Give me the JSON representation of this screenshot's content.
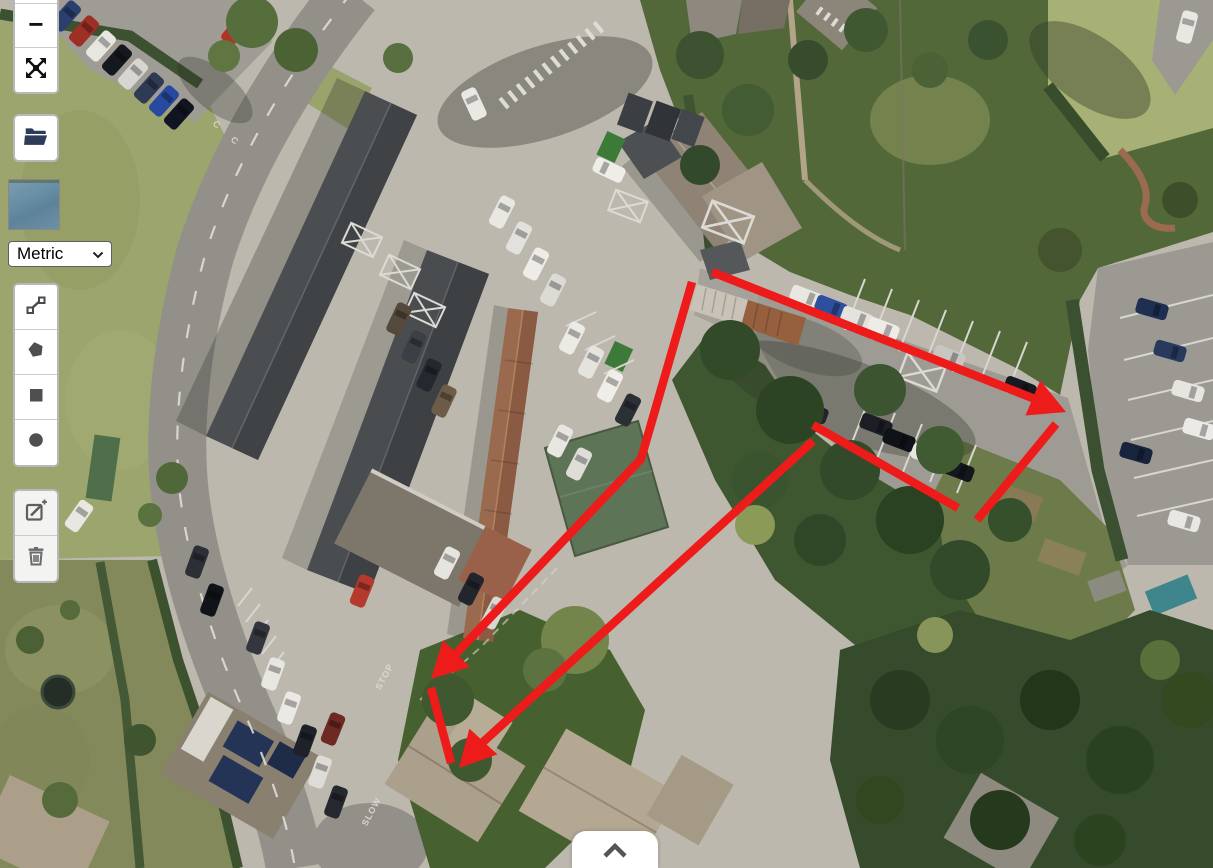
{
  "app": {
    "kind": "map-measurement-tool"
  },
  "units_select": {
    "value": "Metric"
  },
  "controls": {
    "zoom_out_label": "−",
    "fullscreen_icon": "fullscreen-expand-icon",
    "open_file_icon": "folder-open-icon",
    "basemap_thumbnail": "blue-layer-preview",
    "draw_tools": [
      {
        "name": "draw-polyline",
        "icon": "polyline-icon"
      },
      {
        "name": "draw-polygon",
        "icon": "pentagon-icon"
      },
      {
        "name": "draw-rectangle",
        "icon": "square-icon"
      },
      {
        "name": "draw-circle",
        "icon": "circle-icon"
      }
    ],
    "edit_tools": [
      {
        "name": "edit-shapes",
        "icon": "edit-pencil-icon"
      },
      {
        "name": "delete-shapes",
        "icon": "trash-icon"
      }
    ],
    "bottom_panel_icon": "chevron-up-icon"
  },
  "road_markings": {
    "stop": "STOP",
    "slow": "SLOW",
    "bay_letter": "C"
  },
  "annotations": {
    "color": "#ee1b1b",
    "stroke_width": 8.5,
    "arrow_length": 36,
    "arrow_half_width": 19,
    "lines": [
      {
        "points": [
          [
            712,
            272
          ],
          [
            1040,
            401
          ]
        ],
        "arrow": true,
        "tip": [
          1066,
          412
        ]
      },
      {
        "points": [
          [
            1056,
            424
          ],
          [
            977,
            520
          ]
        ],
        "arrow": false
      },
      {
        "points": [
          [
            813,
            425
          ],
          [
            958,
            508
          ]
        ],
        "arrow": false
      },
      {
        "points": [
          [
            813,
            441
          ],
          [
            482,
            743
          ]
        ],
        "arrow": true,
        "tip": [
          459,
          768
        ]
      },
      {
        "points": [
          [
            692,
            282
          ],
          [
            641,
            459
          ],
          [
            450,
            660
          ]
        ],
        "arrow": true,
        "tip": [
          431,
          679
        ]
      },
      {
        "points": [
          [
            431,
            688
          ],
          [
            451,
            763
          ]
        ],
        "arrow": false
      }
    ]
  }
}
